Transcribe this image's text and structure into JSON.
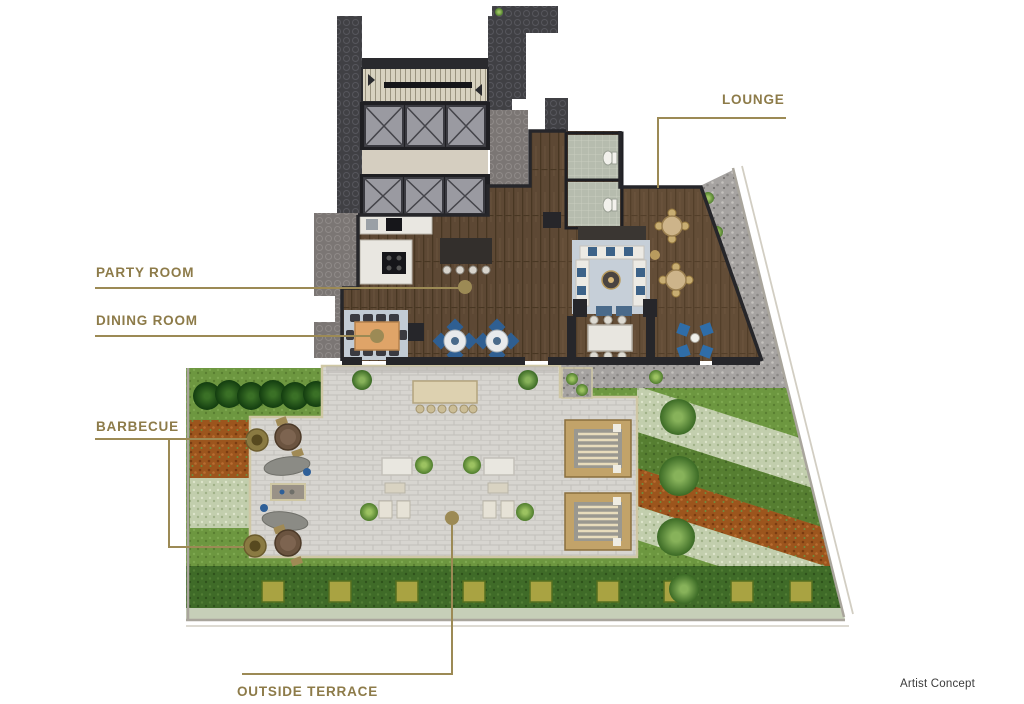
{
  "callouts": {
    "lounge": "LOUNGE",
    "party_room": "PARTY ROOM",
    "dining_room": "DINING ROOM",
    "barbecue": "BARBECUE",
    "outside_terrace": "OUTSIDE TERRACE"
  },
  "footnote": "Artist Concept",
  "colors": {
    "background": "#ffffff",
    "label_gold": "#8d7b49",
    "callout_line": "#9c8a55",
    "footnote_gray": "#3b3b3b",
    "wood_floor": "#5d4834",
    "terrace_paver": "#d7d5d0",
    "grass_green": "#6d9740",
    "core_charcoal": "#404044"
  }
}
